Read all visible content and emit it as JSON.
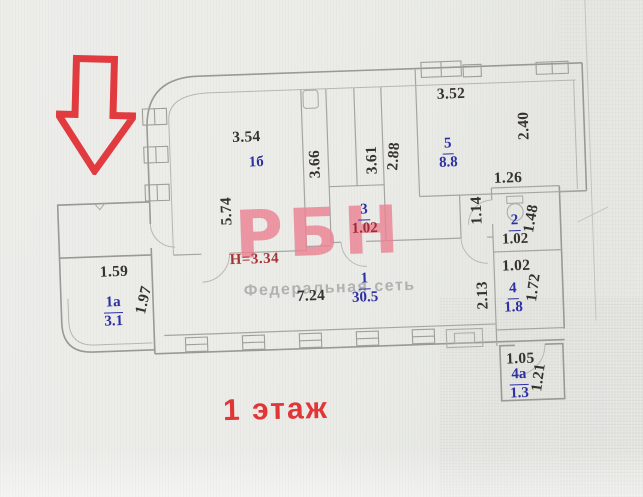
{
  "plan": {
    "floor_label": "1 этаж",
    "ceiling_height_note": "Н=3.34",
    "watermark": {
      "brand": "РБН",
      "subtitle": "Федеральная сеть"
    },
    "rooms": [
      {
        "number": "1б",
        "area": ""
      },
      {
        "number": "5",
        "area": "8.8"
      },
      {
        "number": "3",
        "area": "1.02"
      },
      {
        "number": "2",
        "area": "1.02"
      },
      {
        "number": "1",
        "area": "30.5"
      },
      {
        "number": "4",
        "area": "1.8"
      },
      {
        "number": "4а",
        "area": "1.3"
      },
      {
        "number": "1а",
        "area": "3.1"
      }
    ],
    "dimensions": {
      "d354": "3.54",
      "d574": "5.74",
      "d366": "3.66",
      "d361": "3.61",
      "d288": "2.88",
      "d352": "3.52",
      "d240": "2.40",
      "d126": "1.26",
      "d114": "1.14",
      "d148": "1.48",
      "d102": "1.02",
      "d172": "1.72",
      "d213": "2.13",
      "d105": "1.05",
      "d121": "1.21",
      "d724": "7.24",
      "d159": "1.59",
      "d197": "1.97"
    },
    "colors": {
      "arrow_red": "#e23a3e",
      "label_blue": "#2c2ea4",
      "note_red": "#a83236",
      "floor_label_red": "#e23537",
      "watermark_pink": "#ec8294",
      "watermark_gray": "#b2b2b0",
      "wall_gray": "#9b9995"
    },
    "icons": [
      "entrance-down-arrow-icon",
      "toilet-icon",
      "sink-icon",
      "window-symbol",
      "door-arc"
    ]
  }
}
